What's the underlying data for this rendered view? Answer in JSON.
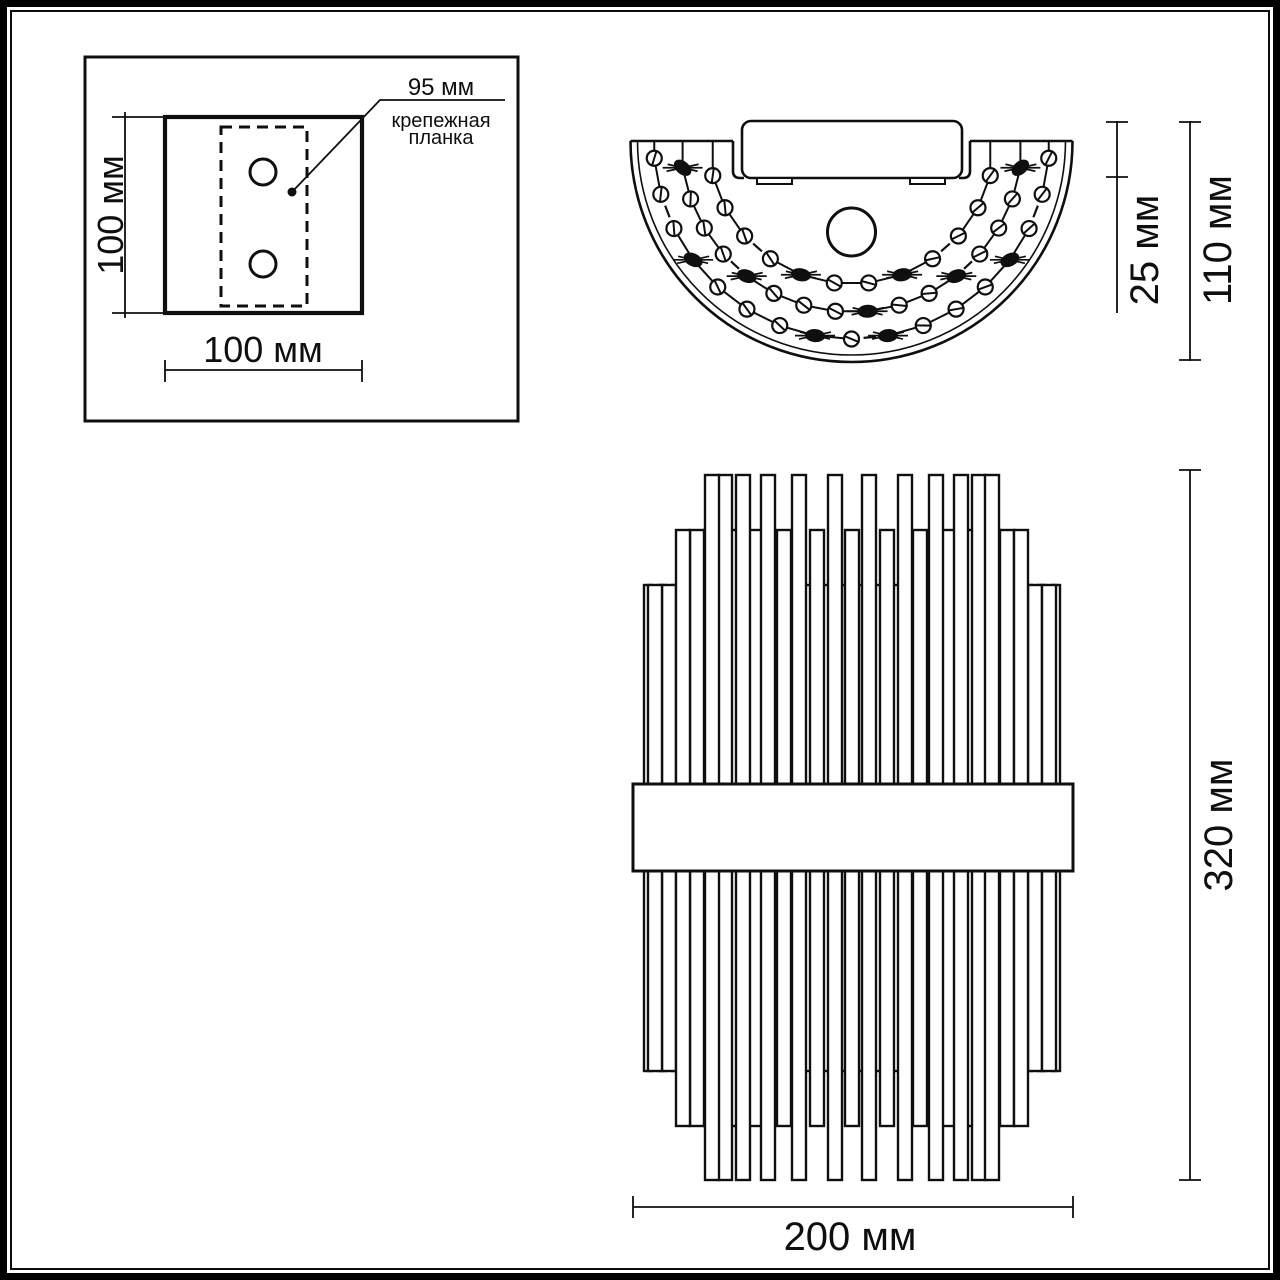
{
  "title": "wall-lamp dimensional drawing",
  "colors": {
    "ink": "#0f0f0f",
    "paper": "#ffffff"
  },
  "views": {
    "mounting_plate": {
      "name": "mounting plate rear view",
      "labels": {
        "height": "100 мм",
        "width": "100 мм",
        "bracket_offset": "95 мм",
        "bracket_line1": "крепежная",
        "bracket_line2": "планка"
      }
    },
    "top_view": {
      "name": "top view",
      "labels": {
        "canopy_depth": "25 мм",
        "total_depth": "110 мм"
      }
    },
    "front_view": {
      "name": "front view",
      "labels": {
        "height": "320 мм",
        "width": "200 мм"
      }
    }
  }
}
